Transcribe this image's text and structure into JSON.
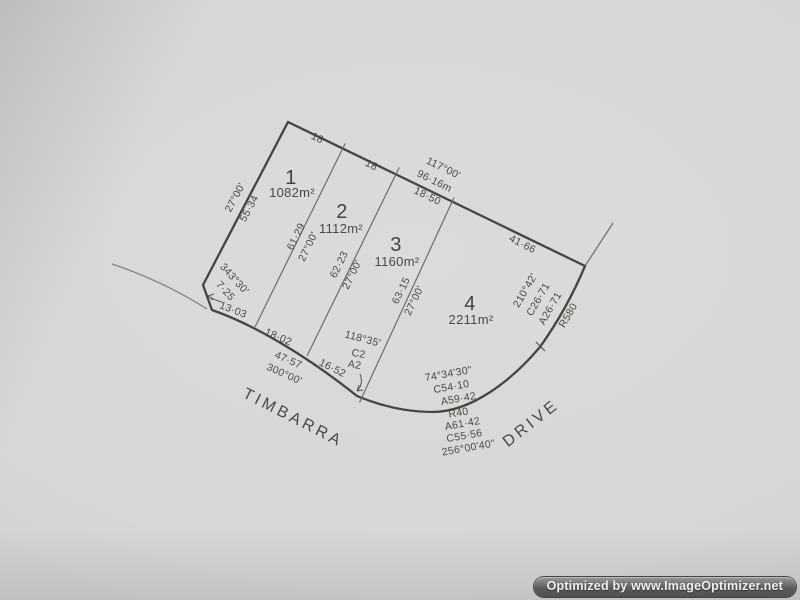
{
  "survey": {
    "lots": [
      {
        "number": "1",
        "area": "1082m²"
      },
      {
        "number": "2",
        "area": "1112m²"
      },
      {
        "number": "3",
        "area": "1160m²"
      },
      {
        "number": "4",
        "area": "2211m²"
      }
    ],
    "top_boundary": {
      "seg1": "18",
      "seg2": "18",
      "bearing": "117°00'",
      "total": "96·16m",
      "seg3": "18·50",
      "seg4": "41·66"
    },
    "left_boundary": {
      "bearing": "27°00'",
      "length": "55·34"
    },
    "left_splay": {
      "bearing": "343°30'",
      "length": "7·25"
    },
    "bottom_boundary": {
      "seg1": "13·03",
      "seg2": "18·02",
      "total": "47·57",
      "bearing": "300°00'",
      "seg3": "16·52"
    },
    "divider_1_2": {
      "length": "61·29",
      "bearing": "27°00'"
    },
    "divider_2_3": {
      "length": "62·23",
      "bearing": "27°00'"
    },
    "divider_3_4": {
      "length": "63·15",
      "bearing": "27°00'"
    },
    "divider_3_4_curve": {
      "bearing": "118°35'",
      "chord": "C2",
      "arc": "A2"
    },
    "right_curve": {
      "bearing": "210°42'",
      "chord": "C26·71",
      "arc": "A26·71",
      "radius": "R580"
    },
    "front_curve_upper": {
      "bearing": "74°34'30\"",
      "chord": "C54·10",
      "arc": "A59·42"
    },
    "front_curve_lower": {
      "radius": "R40",
      "arc": "A61·42",
      "chord": "C55·56",
      "bearing": "256°00'40\""
    },
    "streets": {
      "timbarra": "TIMBARRA",
      "drive": "DRIVE"
    }
  },
  "watermark": {
    "text": "Optimized by www.ImageOptimizer.net"
  }
}
